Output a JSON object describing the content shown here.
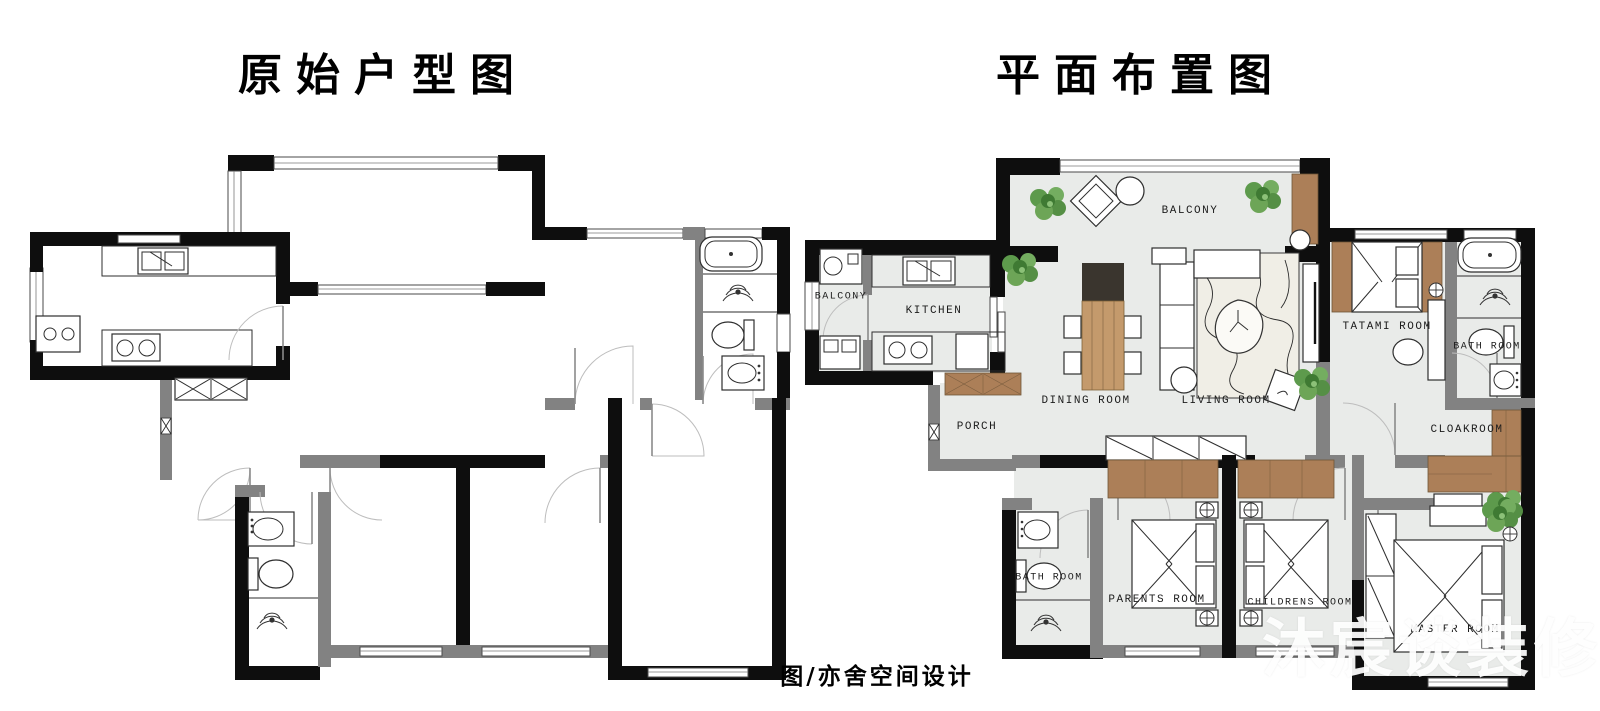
{
  "left_panel": {
    "title": "原始户型图"
  },
  "right_panel": {
    "title": "平面布置图",
    "rooms": {
      "balcony_top": {
        "label": "BALCONY"
      },
      "balcony_left": {
        "label": "BALCONY"
      },
      "kitchen": {
        "label": "KITCHEN"
      },
      "porch": {
        "label": "PORCH"
      },
      "dining": {
        "label": "DINING ROOM"
      },
      "living": {
        "label": "LIVING ROOM"
      },
      "tatami": {
        "label": "TATAMI ROOM"
      },
      "bath_right": {
        "label": "BATH ROOM"
      },
      "cloakroom": {
        "label": "CLOAKROOM"
      },
      "bath_bottom": {
        "label": "BATH ROOM"
      },
      "parents": {
        "label": "PARENTS ROOM"
      },
      "childrens": {
        "label": "CHILDRENS ROOM"
      },
      "master": {
        "label": "MASTER ROOM"
      }
    }
  },
  "caption": "图/亦舍空间设计",
  "watermark": "沐宸谈装修",
  "colors": {
    "wall_black": "#0e0e0e",
    "wall_gray": "#828282",
    "floor_gray": "#e9ebe9",
    "wood_brown": "#ac7f58",
    "oak": "#c49a6c",
    "plant_green": "#66a355",
    "rug_beige": "#f0eee6",
    "watermark_white": "#ffffff"
  }
}
